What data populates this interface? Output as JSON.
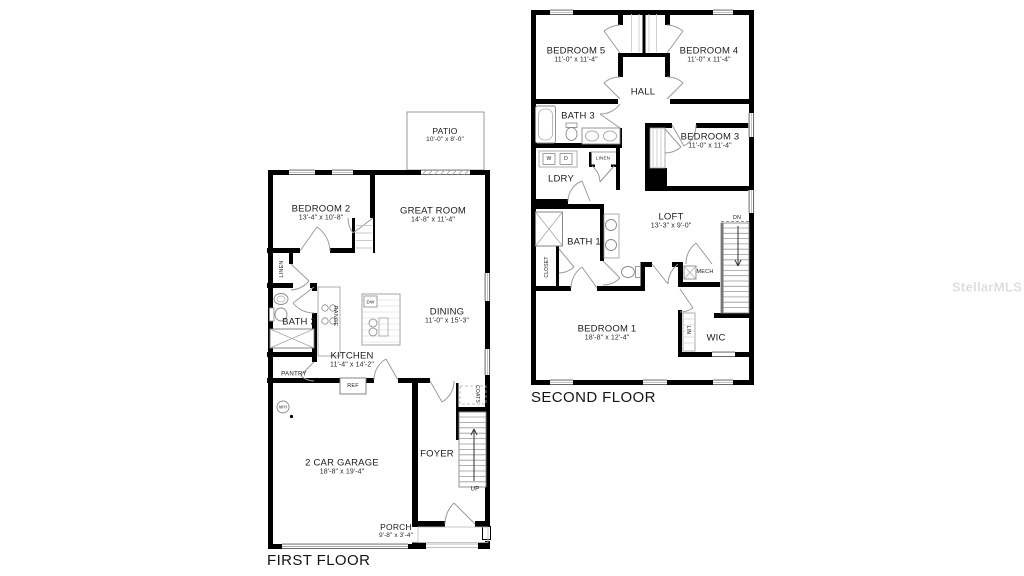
{
  "watermark": "StellarMLS",
  "first_floor": {
    "title": "FIRST FLOOR",
    "rooms": {
      "patio": {
        "name": "PATIO",
        "dims": "10'-0\" x 8'-0\""
      },
      "bedroom2": {
        "name": "BEDROOM 2",
        "dims": "13'-4\" x 10'-8\""
      },
      "great_room": {
        "name": "GREAT ROOM",
        "dims": "14'-8\" x 11'-4\""
      },
      "dining": {
        "name": "DINING",
        "dims": "11'-0\" x 15'-3\""
      },
      "kitchen": {
        "name": "KITCHEN",
        "dims": "11'-4\" x 14'-2\""
      },
      "bath2": {
        "name": "BATH 2"
      },
      "garage": {
        "name": "2 CAR GARAGE",
        "dims": "18'-8\" x 19'-4\""
      },
      "foyer": {
        "name": "FOYER"
      },
      "porch": {
        "name": "PORCH",
        "dims": "9'-8\" x 3'-4\""
      }
    },
    "fixtures": {
      "linen": "LINEN",
      "pantry": "PANTRY",
      "range": "RANGE",
      "dw": "DW",
      "ref": "REF",
      "wh": "WH",
      "coats": "COATS",
      "up": "UP"
    }
  },
  "second_floor": {
    "title": "SECOND FLOOR",
    "rooms": {
      "bedroom5": {
        "name": "BEDROOM 5",
        "dims": "11'-0\" x 11'-4\""
      },
      "bedroom4": {
        "name": "BEDROOM 4",
        "dims": "11'-0\" x 11'-4\""
      },
      "bedroom3": {
        "name": "BEDROOM 3",
        "dims": "11'-0\" x 11'-4\""
      },
      "bedroom1": {
        "name": "BEDROOM 1",
        "dims": "18'-8\" x 12'-4\""
      },
      "hall": {
        "name": "HALL"
      },
      "bath3": {
        "name": "BATH 3"
      },
      "bath1": {
        "name": "BATH 1"
      },
      "ldry": {
        "name": "LDRY"
      },
      "loft": {
        "name": "LOFT",
        "dims": "13'-3\" x 9'-0\""
      },
      "wic": {
        "name": "WIC"
      }
    },
    "fixtures": {
      "w": "W",
      "d": "D",
      "linen": "LINEN",
      "closet": "CLOSET",
      "mech": "MECH",
      "lin": "LIN",
      "dn": "DN"
    }
  },
  "colors": {
    "wall": "#000000",
    "door": "#9a9a9a",
    "fixture": "#888888",
    "background": "#ffffff"
  }
}
